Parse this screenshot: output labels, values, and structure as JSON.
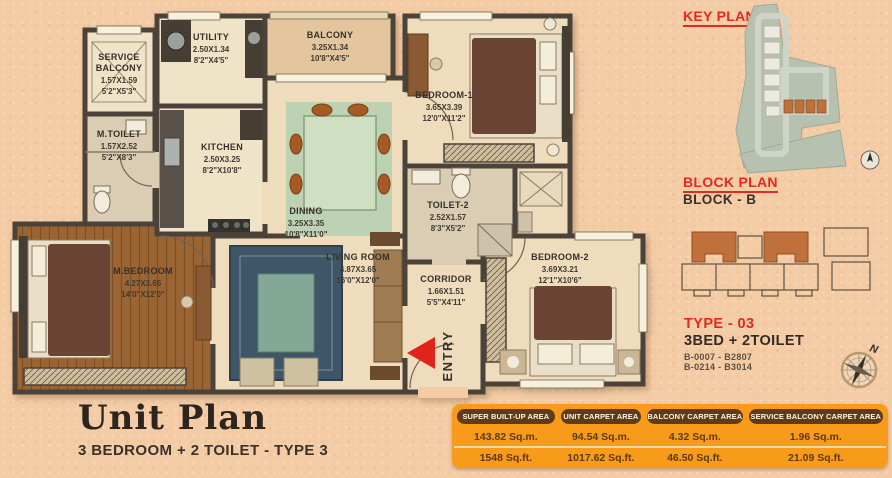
{
  "title": {
    "heading": "Unit Plan",
    "subheading": "3 BEDROOM + 2 TOILET - TYPE 3"
  },
  "plan": {
    "entry_label": "ENTRY",
    "rooms": {
      "service_balcony": {
        "line1": "SERVICE",
        "line2": "BALCONY",
        "dim_m": "1.57X1.59",
        "dim_ft": "5'2\"X5'3\""
      },
      "m_toilet": {
        "line1": "M.TOILET",
        "dim_m": "1.57X2.52",
        "dim_ft": "5'2\"X8'3\""
      },
      "utility": {
        "line1": "UTILITY",
        "dim_m": "2.50X1.34",
        "dim_ft": "8'2\"X4'5\""
      },
      "balcony": {
        "line1": "BALCONY",
        "dim_m": "3.25X1.34",
        "dim_ft": "10'8\"X4'5\""
      },
      "kitchen": {
        "line1": "KITCHEN",
        "dim_m": "2.50X3.25",
        "dim_ft": "8'2\"X10'8\""
      },
      "dining": {
        "line1": "DINING",
        "dim_m": "3.25X3.35",
        "dim_ft": "10'8\"X11'0\""
      },
      "bedroom1": {
        "line1": "BEDROOM-1",
        "dim_m": "3.65X3.39",
        "dim_ft": "12'0\"X11'2\""
      },
      "toilet2": {
        "line1": "TOILET-2",
        "dim_m": "2.52X1.57",
        "dim_ft": "8'3\"X5'2\""
      },
      "m_bedroom": {
        "line1": "M.BEDROOM",
        "dim_m": "4.27X3.65",
        "dim_ft": "14'0\"X12'0\""
      },
      "living_room": {
        "line1": "LIVING ROOM",
        "dim_m": "4.87X3.65",
        "dim_ft": "16'0\"X12'0\""
      },
      "corridor": {
        "line1": "CORRIDOR",
        "dim_m": "1.66X1.51",
        "dim_ft": "5'5\"X4'11\""
      },
      "bedroom2": {
        "line1": "BEDROOM-2",
        "dim_m": "3.69X3.21",
        "dim_ft": "12'1\"X10'6\""
      }
    }
  },
  "key_plan": {
    "title": "KEY PLAN"
  },
  "block_plan": {
    "title": "BLOCK PLAN",
    "block": "BLOCK - B"
  },
  "unit_type": {
    "type": "TYPE - 03",
    "config": "3BED + 2TOILET",
    "units_line1": "B-0007 - B2807",
    "units_line2": "B-0214 - B3014"
  },
  "compass": {
    "north_label": "N"
  },
  "area_table": {
    "columns": [
      {
        "header": "SUPER BUILT-UP AREA",
        "sqm": "143.82 Sq.m.",
        "sqft": "1548 Sq.ft."
      },
      {
        "header": "UNIT CARPET AREA",
        "sqm": "94.54 Sq.m.",
        "sqft": "1017.62 Sq.ft."
      },
      {
        "header": "BALCONY CARPET AREA",
        "sqm": "4.32 Sq.m.",
        "sqft": "46.50 Sq.ft."
      },
      {
        "header": "SERVICE BALCONY CARPET AREA",
        "sqm": "1.96 Sq.m.",
        "sqft": "21.09 Sq.ft."
      }
    ]
  },
  "colors": {
    "accent_red": "#e4291d",
    "table_orange": "#f89b1b",
    "header_brown": "#5f3c17",
    "wall": "#4b423a"
  }
}
